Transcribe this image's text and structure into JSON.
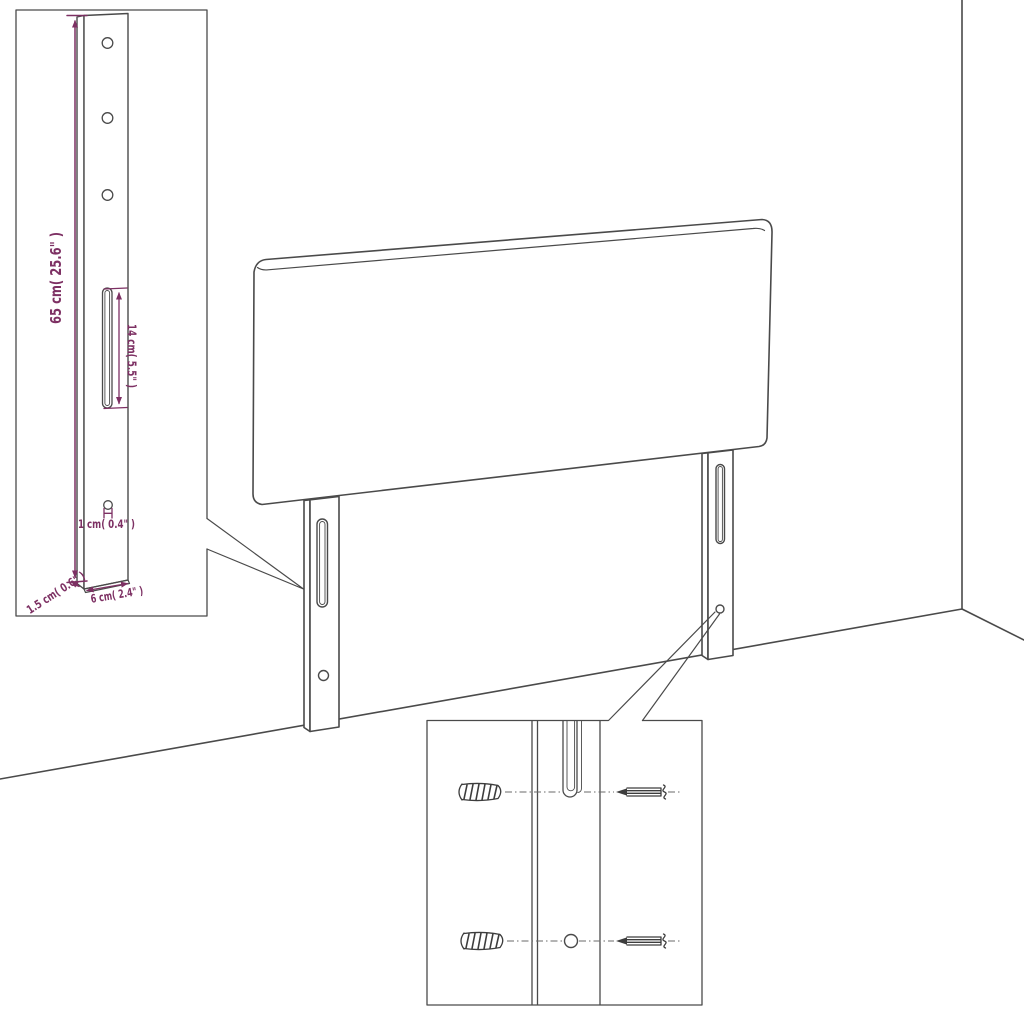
{
  "diagram": {
    "type": "furniture-dimension-diagram",
    "subject": "headboard-with-mounting-legs",
    "colors": {
      "background": "#ffffff",
      "line": "#4a4a4a",
      "dimension": "#7d3063"
    },
    "labels": {
      "leg_height": "65 cm( 25.6\" )",
      "slot_length": "14 cm( 5.5\" )",
      "hole_diameter": "1 cm( 0.4\" )",
      "leg_thickness": "1.5 cm( 0.6\" )",
      "leg_width": "6 cm( 2.4\" )"
    }
  }
}
